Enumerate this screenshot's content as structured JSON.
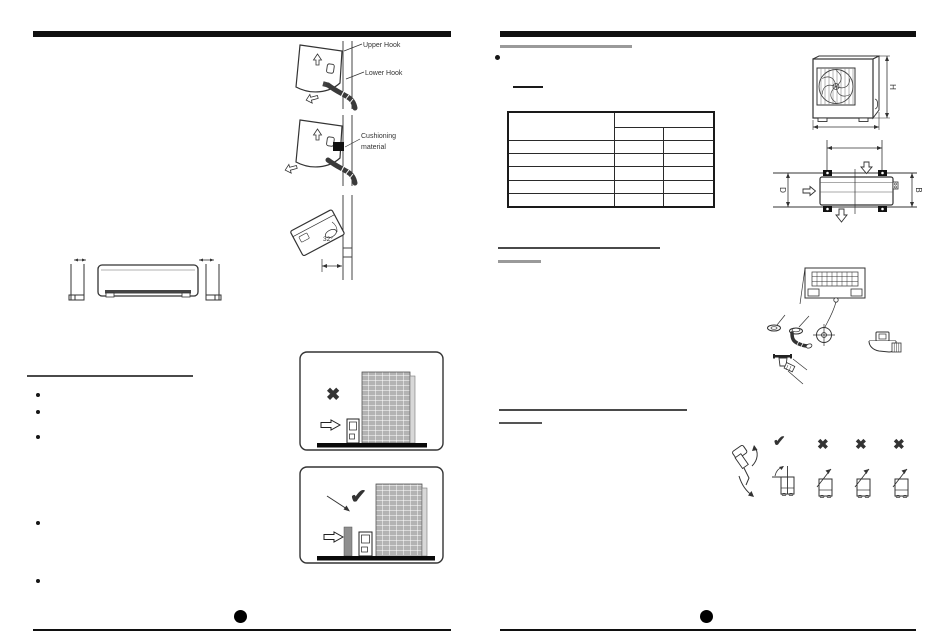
{
  "page_spread": {
    "left": {
      "hook_labels": {
        "upper": "Upper Hook",
        "lower": "Lower Hook"
      },
      "cushioning": {
        "line1": "Cushioning",
        "line2": "material"
      },
      "tilt_angle": "32°",
      "siting": {
        "wrong_mark": "✖",
        "correct_mark": "✔"
      }
    },
    "right": {
      "dims": {
        "height": "H",
        "depth": "D",
        "width": "B"
      },
      "handling_marks": {
        "ok": "✔",
        "wrong1": "✖",
        "wrong2": "✖",
        "wrong3": "✖"
      }
    },
    "colors": {
      "ink": "#222222",
      "rule_gray": "#9a9a9a",
      "building_gray": "#b3b3b3"
    }
  }
}
